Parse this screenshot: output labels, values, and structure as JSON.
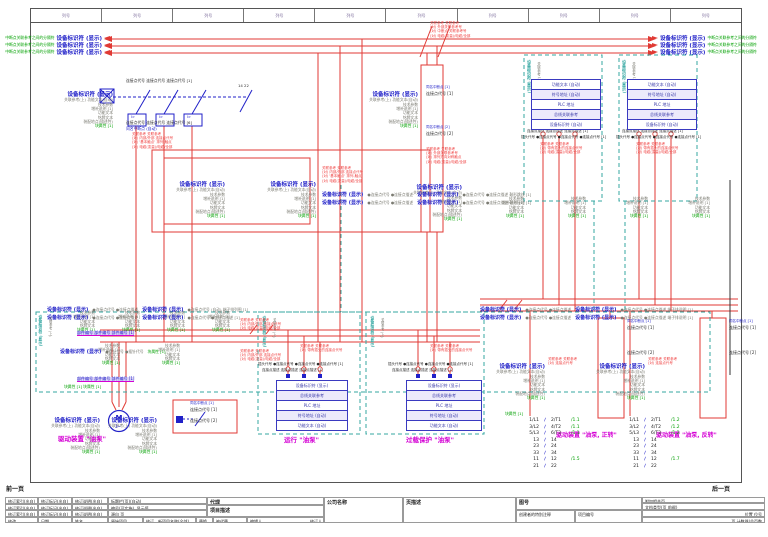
{
  "frame": {
    "columns": 10,
    "column_label": "列号"
  },
  "strings": {
    "device_tag": "设备标识符 (显示)",
    "std_sub": "关联参考(上) 功能文本(自动)",
    "std_lines": [
      "技术参数",
      "增补说明 [1]",
      "功能文本",
      "铭牌文本",
      "装配地点(描述性)"
    ],
    "std_green": "块属性 [1]"
  },
  "bus": {
    "green_left": "中断点关联参考之间的分隔符",
    "green_right": "中断点关联参考之间的分隔符",
    "tag": "设备标识符 (显示)",
    "left_rows": [
      35,
      42,
      49
    ],
    "right_rows": [
      35,
      42,
      49
    ]
  },
  "plc": {
    "top_rows": [
      "功能文本 (自动)",
      "符号地址 (自动)",
      "PLC 地址",
      "总线关联参考",
      "设备标识符 (自动)"
    ],
    "bottom_rows": [
      "设备标识符 (显示)",
      "总线关联参考",
      "PLC 地址",
      "符号地址 (自动)",
      "功能文本 (自动)"
    ],
    "tables": [
      {
        "x": 531,
        "y": 79,
        "w": 68,
        "rowH": 9,
        "set": "top"
      },
      {
        "x": 627,
        "y": 79,
        "w": 68,
        "rowH": 9,
        "set": "top"
      },
      {
        "x": 276,
        "y": 380,
        "w": 70,
        "rowH": 9,
        "set": "bottom"
      },
      {
        "x": 406,
        "y": 380,
        "w": 74,
        "rowH": 9,
        "set": "bottom"
      }
    ]
  },
  "stacks": [
    {
      "x": 113,
      "y": 92,
      "full": true
    },
    {
      "x": 225,
      "y": 182,
      "full": true
    },
    {
      "x": 316,
      "y": 182,
      "full": true
    },
    {
      "x": 462,
      "y": 185,
      "full": true
    },
    {
      "x": 418,
      "y": 92,
      "full": true
    },
    {
      "x": 100,
      "y": 418,
      "full": true
    },
    {
      "x": 157,
      "y": 418,
      "full": true
    },
    {
      "x": 545,
      "y": 364,
      "full": true
    },
    {
      "x": 645,
      "y": 364,
      "full": true
    },
    {
      "x": 524,
      "y": 197,
      "full": false
    },
    {
      "x": 586,
      "y": 197,
      "full": false
    },
    {
      "x": 648,
      "y": 197,
      "full": false
    },
    {
      "x": 710,
      "y": 197,
      "full": false
    },
    {
      "x": 95,
      "y": 311,
      "full": false
    },
    {
      "x": 140,
      "y": 311,
      "full": false
    },
    {
      "x": 185,
      "y": 311,
      "full": false
    },
    {
      "x": 230,
      "y": 311,
      "full": false
    },
    {
      "x": 120,
      "y": 344,
      "full": false
    },
    {
      "x": 180,
      "y": 344,
      "full": false
    }
  ],
  "rows": [
    {
      "x": 322,
      "y": 182,
      "parts": [
        [
          "b",
          "设备标识符 (显示)"
        ],
        [
          "g",
          "●连接点代号 ●连接点描述"
        ],
        [
          "b",
          "设备标识符 (显示)"
        ],
        [
          "g",
          "●连接点代号 ●连接点描述 鞍形跳线  [1]"
        ]
      ]
    },
    {
      "x": 322,
      "y": 190,
      "parts": [
        [
          "b",
          "设备标识符 (显示)"
        ],
        [
          "g",
          "●连接点代号 ●连接点描述"
        ],
        [
          "b",
          "设备标识符 (显示)"
        ],
        [
          "g",
          "●连接点代号 ●连接点描述 鞍形接地  [1]"
        ]
      ]
    },
    {
      "x": 480,
      "y": 297,
      "parts": [
        [
          "b",
          "设备标识符 (显示)"
        ],
        [
          "g",
          "●连接点代号 ●连接点描述"
        ],
        [
          "b",
          "设备标识符 (显示)"
        ],
        [
          "g",
          "●连接点代号 ●连接点描述 端子排说明  [1]"
        ]
      ]
    },
    {
      "x": 480,
      "y": 305,
      "parts": [
        [
          "b",
          "设备标识符 (显示)"
        ],
        [
          "g",
          "●连接点代号 ●连接点描述"
        ],
        [
          "b",
          "设备标识符 (显示)"
        ],
        [
          "g",
          "●连接点代号 ●连接点描述 端子排说明  [1]"
        ]
      ]
    },
    {
      "x": 47,
      "y": 297,
      "parts": [
        [
          "b",
          "设备标识符 (显示)"
        ],
        [
          "g",
          "●连接点代号 ●连接点描述"
        ],
        [
          "b",
          "设备标识符 (显示)"
        ],
        [
          "g",
          "●连接点代号 (自动) 端子排列图  [1]"
        ]
      ]
    },
    {
      "x": 47,
      "y": 305,
      "parts": [
        [
          "b",
          "设备标识符 (显示)"
        ],
        [
          "g",
          "●连接点代号 ●连接点描述"
        ],
        [
          "b",
          "设备标识符 (显示)"
        ],
        [
          "g",
          "●连接点代号 ●连接点描述  [1]"
        ]
      ]
    },
    {
      "x": 60,
      "y": 339,
      "parts": [
        [
          "b",
          "设备标识符 (显示)"
        ],
        [
          "g",
          "●插针代号 ●插针代号"
        ],
        [
          "gr",
          "块属性 [1]"
        ]
      ]
    }
  ],
  "texts": [
    {
      "n": "prev-page",
      "t": "前一页",
      "x": 6,
      "y": 487,
      "c": "kb",
      "s": 6
    },
    {
      "n": "next-page",
      "t": "后一页",
      "x": 712,
      "y": 487,
      "c": "kb",
      "s": 6
    },
    {
      "n": "breaker-pins-top",
      "t": "连接点代号 连接点代号 连接点代号  [1]",
      "x": 126,
      "y": 79,
      "c": "k",
      "s": 3.8
    },
    {
      "n": "breaker-pins-bottom",
      "t": "连接点代号 连接点代号 连接点代号  [6]",
      "x": 126,
      "y": 121,
      "c": "k",
      "s": 3.8
    },
    {
      "n": "breaker-interrupt",
      "t": "同名中断点 (自动)",
      "x": 126,
      "y": 126.5,
      "c": "bl",
      "s": 3.8
    },
    {
      "n": "pole-trip-1",
      "t": "I>",
      "x": 131,
      "y": 116,
      "c": "bl",
      "s": 3.5
    },
    {
      "n": "pole-trip-2",
      "t": "I>",
      "x": 159,
      "y": 116,
      "c": "bl",
      "s": 3.5
    },
    {
      "n": "pole-trip-3",
      "t": "I>",
      "x": 187,
      "y": 116,
      "c": "bl",
      "s": 3.5
    },
    {
      "n": "aux-terminals",
      "t": "14   22",
      "x": 238,
      "y": 84,
      "c": "k",
      "s": 3.8
    },
    {
      "n": "duct-interrupt-1",
      "t": "同名中断点 [1]",
      "x": 426,
      "y": 86,
      "c": "bl",
      "s": 3.5
    },
    {
      "n": "duct-pin-1",
      "t": "连接点代号  [1]",
      "x": 426,
      "y": 91.5,
      "c": "k",
      "s": 4
    },
    {
      "n": "duct-interrupt-2",
      "t": "同名中断点 [2]",
      "x": 426,
      "y": 126,
      "c": "bl",
      "s": 3.5
    },
    {
      "n": "duct-pin-2",
      "t": "连接点代号  [2]",
      "x": 426,
      "y": 131.5,
      "c": "k",
      "s": 4
    },
    {
      "n": "motoraux-interrupt",
      "t": "同名中断点 [1]",
      "x": 190,
      "y": 402,
      "c": "bl",
      "s": 3.5
    },
    {
      "n": "motoraux-pin-1",
      "t": "连接点代号  [1]",
      "x": 190,
      "y": 408,
      "c": "k",
      "s": 4
    },
    {
      "n": "motoraux-pin-2",
      "t": "连接点代号  [2]",
      "x": 190,
      "y": 419,
      "c": "k",
      "s": 4
    },
    {
      "n": "part-number-row-1",
      "t": "部件编号 部件编号 部件编号  [1]",
      "x": 77,
      "y": 331,
      "c": "hl",
      "s": 4
    },
    {
      "n": "part-number-row-2",
      "t": "部件编号 部件编号 部件编号  [1]",
      "x": 77,
      "y": 377,
      "c": "hl",
      "s": 4
    },
    {
      "n": "block-prop-row",
      "t": "块属性 [1]    块属性 [1]",
      "x": 64,
      "y": 385,
      "c": "gr",
      "s": 3.8
    },
    {
      "n": "caption-motor",
      "t": "驱动装置 \"油泵\"",
      "x": 58,
      "y": 436,
      "c": "m",
      "s": 6.5
    },
    {
      "n": "caption-run",
      "t": "运行 \"油泵\"",
      "x": 284,
      "y": 437,
      "c": "m",
      "s": 6.5
    },
    {
      "n": "caption-overload",
      "t": "过载保护 \"油泵\"",
      "x": 406,
      "y": 437,
      "c": "m",
      "s": 6.5
    },
    {
      "n": "caption-fwd",
      "t": "驱动装置 \"油泵, 正转\"",
      "x": 556,
      "y": 433,
      "c": "m",
      "s": 6
    },
    {
      "n": "caption-rev",
      "t": "驱动装置 \"油泵, 反转\"",
      "x": 656,
      "y": 433,
      "c": "m",
      "s": 6
    },
    {
      "n": "plcbox1-rot-tag",
      "t": "设备标识符 (显示)",
      "x": 527,
      "y": 60,
      "c": "t",
      "s": 4,
      "rot": true
    },
    {
      "n": "plcbox1-rot-ref",
      "t": "关联参考 (上)",
      "x": 537,
      "y": 62,
      "c": "g",
      "s": 3.5,
      "rot": true
    },
    {
      "n": "plcbox2-rot-tag",
      "t": "设备标识符 (显示)",
      "x": 622,
      "y": 60,
      "c": "t",
      "s": 4,
      "rot": true
    },
    {
      "n": "plcbox2-rot-ref",
      "t": "关联参考 (上)",
      "x": 632,
      "y": 62,
      "c": "g",
      "s": 3.5,
      "rot": true
    },
    {
      "n": "iobox1-rot-tag",
      "t": "设备标识符 (显示)",
      "x": 263,
      "y": 316,
      "c": "t",
      "s": 3.8,
      "rot": true
    },
    {
      "n": "iobox1-rot-ref",
      "t": "关联参考 (上)",
      "x": 272,
      "y": 318,
      "c": "g",
      "s": 3.2,
      "rot": true
    },
    {
      "n": "iobox2-rot-tag",
      "t": "设备标识符 (显示)",
      "x": 371,
      "y": 316,
      "c": "t",
      "s": 3.8,
      "rot": true
    },
    {
      "n": "iobox2-rot-ref",
      "t": "关联参考 (上)",
      "x": 380,
      "y": 318,
      "c": "g",
      "s": 3.2,
      "rot": true
    },
    {
      "n": "macrobox-rot-tag",
      "t": "设备标识符 (显示)",
      "x": 39,
      "y": 315,
      "c": "t",
      "s": 3.8,
      "rot": true
    },
    {
      "n": "macrobox-rot-ref",
      "t": "关联参考 (上)",
      "x": 48,
      "y": 317,
      "c": "g",
      "s": 3.2,
      "rot": true
    },
    {
      "n": "plcbox1-pin-desc",
      "t": "连接点描述 连接点描述 连接点描述  [1]",
      "x": 527,
      "y": 130,
      "c": "k",
      "s": 3.5
    },
    {
      "n": "plcbox1-plug",
      "t": "插头代号 ●连接点代号 ●连接点代号 ●连接点代号  [1]",
      "x": 521,
      "y": 135.5,
      "c": "k",
      "s": 3.5
    },
    {
      "n": "plcbox2-pin-desc",
      "t": "连接点描述 连接点描述 连接点描述  [1]",
      "x": 622,
      "y": 130,
      "c": "k",
      "s": 3.5
    },
    {
      "n": "plcbox2-plug",
      "t": "插头代号 ●连接点代号 ●连接点代号 ●连接点代号  [1]",
      "x": 616,
      "y": 135.5,
      "c": "k",
      "s": 3.5
    },
    {
      "n": "iobox1-plug",
      "t": "插头代号 ●连接点代号 ●连接点代号 ●连接点代号  [1]",
      "x": 258,
      "y": 363,
      "c": "k",
      "s": 3.5
    },
    {
      "n": "iobox1-pin-desc",
      "t": "连接点描述 连接点描述 连接点描述  [1]",
      "x": 262,
      "y": 369,
      "c": "k",
      "s": 3.5
    },
    {
      "n": "iobox2-plug",
      "t": "插头代号 ●连接点代号 ●连接点代号 ●连接点代号  [1]",
      "x": 388,
      "y": 363,
      "c": "k",
      "s": 3.5
    },
    {
      "n": "iobox2-pin-desc",
      "t": "连接点描述 连接点描述 连接点描述  [1]",
      "x": 392,
      "y": 369,
      "c": "k",
      "s": 3.5
    },
    {
      "n": "termA-interrupt",
      "t": "同名中断点 [1]",
      "x": 627,
      "y": 320,
      "c": "bl",
      "s": 3.5
    },
    {
      "n": "termA-pin-1",
      "t": "连接点代号  [1]",
      "x": 627,
      "y": 325.5,
      "c": "k",
      "s": 4
    },
    {
      "n": "termA-pin-2",
      "t": "连接点代号  [2]",
      "x": 627,
      "y": 351,
      "c": "k",
      "s": 4
    },
    {
      "n": "termB-interrupt",
      "t": "同名中断点 [1]",
      "x": 729,
      "y": 320,
      "c": "bl",
      "s": 3.5
    },
    {
      "n": "termB-pin-1",
      "t": "连接点代号  [1]",
      "x": 729,
      "y": 325.5,
      "c": "k",
      "s": 4
    },
    {
      "n": "termB-pin-2",
      "t": "连接点代号  [2]",
      "x": 729,
      "y": 351,
      "c": "k",
      "s": 4
    },
    {
      "n": "block-prop-br",
      "t": "块属性 [1]",
      "x": 505,
      "y": 412,
      "c": "gr",
      "s": 3.8
    },
    {
      "n": "motor-letter",
      "t": "M",
      "x": 115.5,
      "y": 414.5,
      "c": "b",
      "s": 7
    },
    {
      "n": "motor-phase",
      "t": "3~",
      "x": 115,
      "y": 424.5,
      "c": "bl",
      "s": 4
    }
  ],
  "annots": [
    {
      "x": 132,
      "y": 132,
      "lines": [
        "关联参考 关联参考",
        "(对) 内部/外部 连接点代号",
        "(对) '基本触点' 排列-触点",
        "(对) 电缆(变量)/电缆/全部"
      ]
    },
    {
      "x": 430,
      "y": 21,
      "lines": [
        "关联参考 关联参考",
        "(对) 外部关联参考号",
        "(对) 中断点 关联参考号",
        "(对) 电缆(变量)/电缆/全部"
      ]
    },
    {
      "x": 322,
      "y": 166,
      "lines": [
        "关联参考 关联参考",
        "(对) 内部/外部 连接点代号",
        "(对) '基本触点' 排列-触点",
        "(对) 电缆(变量)/电缆/全部"
      ]
    },
    {
      "x": 426,
      "y": 147,
      "lines": [
        "关联参考 关联参考",
        "(对) 外部关联参考号",
        "(对) 排列方向对称触点",
        "(对) 电缆(变量)/电缆/全部"
      ]
    },
    {
      "x": 540,
      "y": 142,
      "lines": [
        "关联参考 关联参考",
        "(对) 带有插头的连接点代号",
        "(对) 电缆(变量)/电缆/全部"
      ]
    },
    {
      "x": 636,
      "y": 142,
      "lines": [
        "关联参考 关联参考",
        "(对) 带有插头的连接点代号",
        "(对) 电缆(变量)/电缆/全部"
      ]
    },
    {
      "x": 300,
      "y": 344,
      "lines": [
        "关联参考 关联参考",
        "(对) 带有插头的连接点代号"
      ]
    },
    {
      "x": 430,
      "y": 344,
      "lines": [
        "关联参考 关联参考",
        "(对) 带有插头的连接点代号"
      ]
    },
    {
      "x": 240,
      "y": 318,
      "lines": [
        "关联参考 关联参考",
        "(对) 内部/外部 连接点代号",
        "(对) 电缆(变量)/电缆/全部"
      ]
    },
    {
      "x": 240,
      "y": 349,
      "lines": [
        "关联参考 关联参考",
        "(对) 内部/外部 连接点代号",
        "(对) 电缆(变量)/电缆/全部"
      ]
    },
    {
      "x": 548,
      "y": 357,
      "lines": [
        "关联参考 关联参考",
        "(对) 连接点代号"
      ]
    },
    {
      "x": 648,
      "y": 357,
      "lines": [
        "关联参考 关联参考",
        "(对) 连接点代号"
      ]
    }
  ],
  "mirrors": [
    {
      "x": 522,
      "y": 418,
      "rows": [
        {
          "l": "1/L1",
          "r": "2/T1",
          "ref": "/1.1"
        },
        {
          "l": "3/L2",
          "r": "4/T2",
          "ref": "/1.1"
        },
        {
          "l": "5/L3",
          "r": "6/T3",
          "ref": "/1.1"
        },
        {
          "l": "13",
          "r": "14",
          "ref": ""
        },
        {
          "l": "23",
          "r": "24",
          "ref": ""
        },
        {
          "l": "33",
          "r": "34",
          "ref": ""
        },
        {
          "l": "11",
          "r": "12",
          "ref": "/1.5"
        },
        {
          "l": "21",
          "r": "22",
          "ref": ""
        }
      ]
    },
    {
      "x": 622,
      "y": 418,
      "rows": [
        {
          "l": "1/L1",
          "r": "2/T1",
          "ref": "/1.2"
        },
        {
          "l": "3/L2",
          "r": "4/T2",
          "ref": "/1.2"
        },
        {
          "l": "5/L3",
          "r": "6/T3",
          "ref": "/1.2"
        },
        {
          "l": "13",
          "r": "14",
          "ref": ""
        },
        {
          "l": "23",
          "r": "24",
          "ref": ""
        },
        {
          "l": "33",
          "r": "34",
          "ref": ""
        },
        {
          "l": "11",
          "r": "12",
          "ref": "/1.7"
        },
        {
          "l": "21",
          "r": "22",
          "ref": ""
        }
      ]
    }
  ],
  "title_block": {
    "rev_rows": [
      [
        "修订索引(出自)",
        "修订标记(出自)",
        "修订说明(出自)",
        "标题栏(页)(自动)"
      ],
      [
        "修订索引(出自)",
        "修订标记(出自)",
        "修订说明(出自)",
        "编号(可实施), 显示值"
      ],
      [
        "修订索引(出自)",
        "修订标记(出自)",
        "修订说明(出自)",
        "源自 页"
      ]
    ],
    "bottom_cells": [
      {
        "t": "修改",
        "x": 5,
        "w": 33
      },
      {
        "t": "日期",
        "x": 38,
        "w": 34
      },
      {
        "t": "姓名",
        "x": 72,
        "w": 36
      },
      {
        "t": "原始项目",
        "x": 108,
        "w": 35
      },
      {
        "t": "修订、新项目名称(全部)",
        "x": 143,
        "w": 53
      },
      {
        "t": "替换",
        "x": 196,
        "w": 17
      },
      {
        "t": "被代替",
        "x": 213,
        "w": 34
      }
    ],
    "agent": "代理",
    "project_desc": "项目描述",
    "editor": "编辑人",
    "reviser": "修订人",
    "company": "公司名称",
    "page_desc": "页描述",
    "drawing_no": "图号",
    "related_page": "附加相关页",
    "doc_type": "文档类型(页 前缀)",
    "creator_note": "创建者的特别注释",
    "project_no": "项目编号",
    "location": "位置   位号",
    "page_counter": "页 计数器/总页数"
  }
}
